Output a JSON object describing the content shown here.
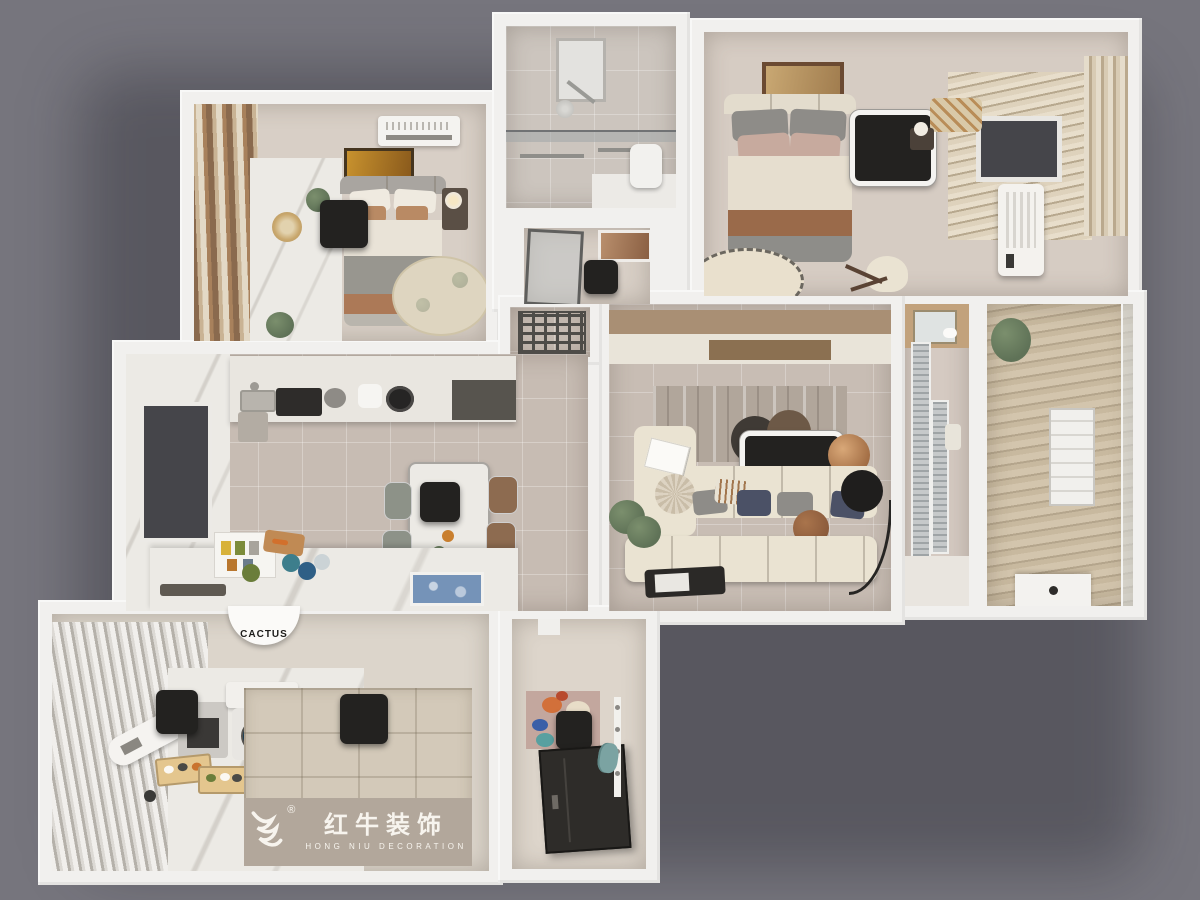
{
  "branding": {
    "registered": "®",
    "logo_cn": "红牛装饰",
    "logo_en": "HONG NIU DECORATION"
  },
  "signs": {
    "cactus": "CACTUS"
  },
  "palette": {
    "bg": "#76757d",
    "wall": "#f1f0ee",
    "tile": "#c7bcb3",
    "beige": "#d8cfc6",
    "marble": "#eceae5",
    "wood": "#a98f74",
    "wood_dark": "#8b7051",
    "black_box": "#232220",
    "sofa": "#eae3d2",
    "blanket_gray": "#98968f",
    "blanket_brown": "#ac7957",
    "rug": "#b1a69b",
    "tatami": "#d3c9b9",
    "logo_band": "#b2a79b",
    "logo_text": "#f7f4ee",
    "navy": "#4b5166",
    "teal": "#7ba3a2",
    "glass": "#aab0b2",
    "window_dark": "#45454a",
    "plant_green": "#5f7257",
    "accent_blue": "#7593b8",
    "curtain_brown": "#8a6a4e",
    "curtain_cream": "#e3d9c6"
  }
}
